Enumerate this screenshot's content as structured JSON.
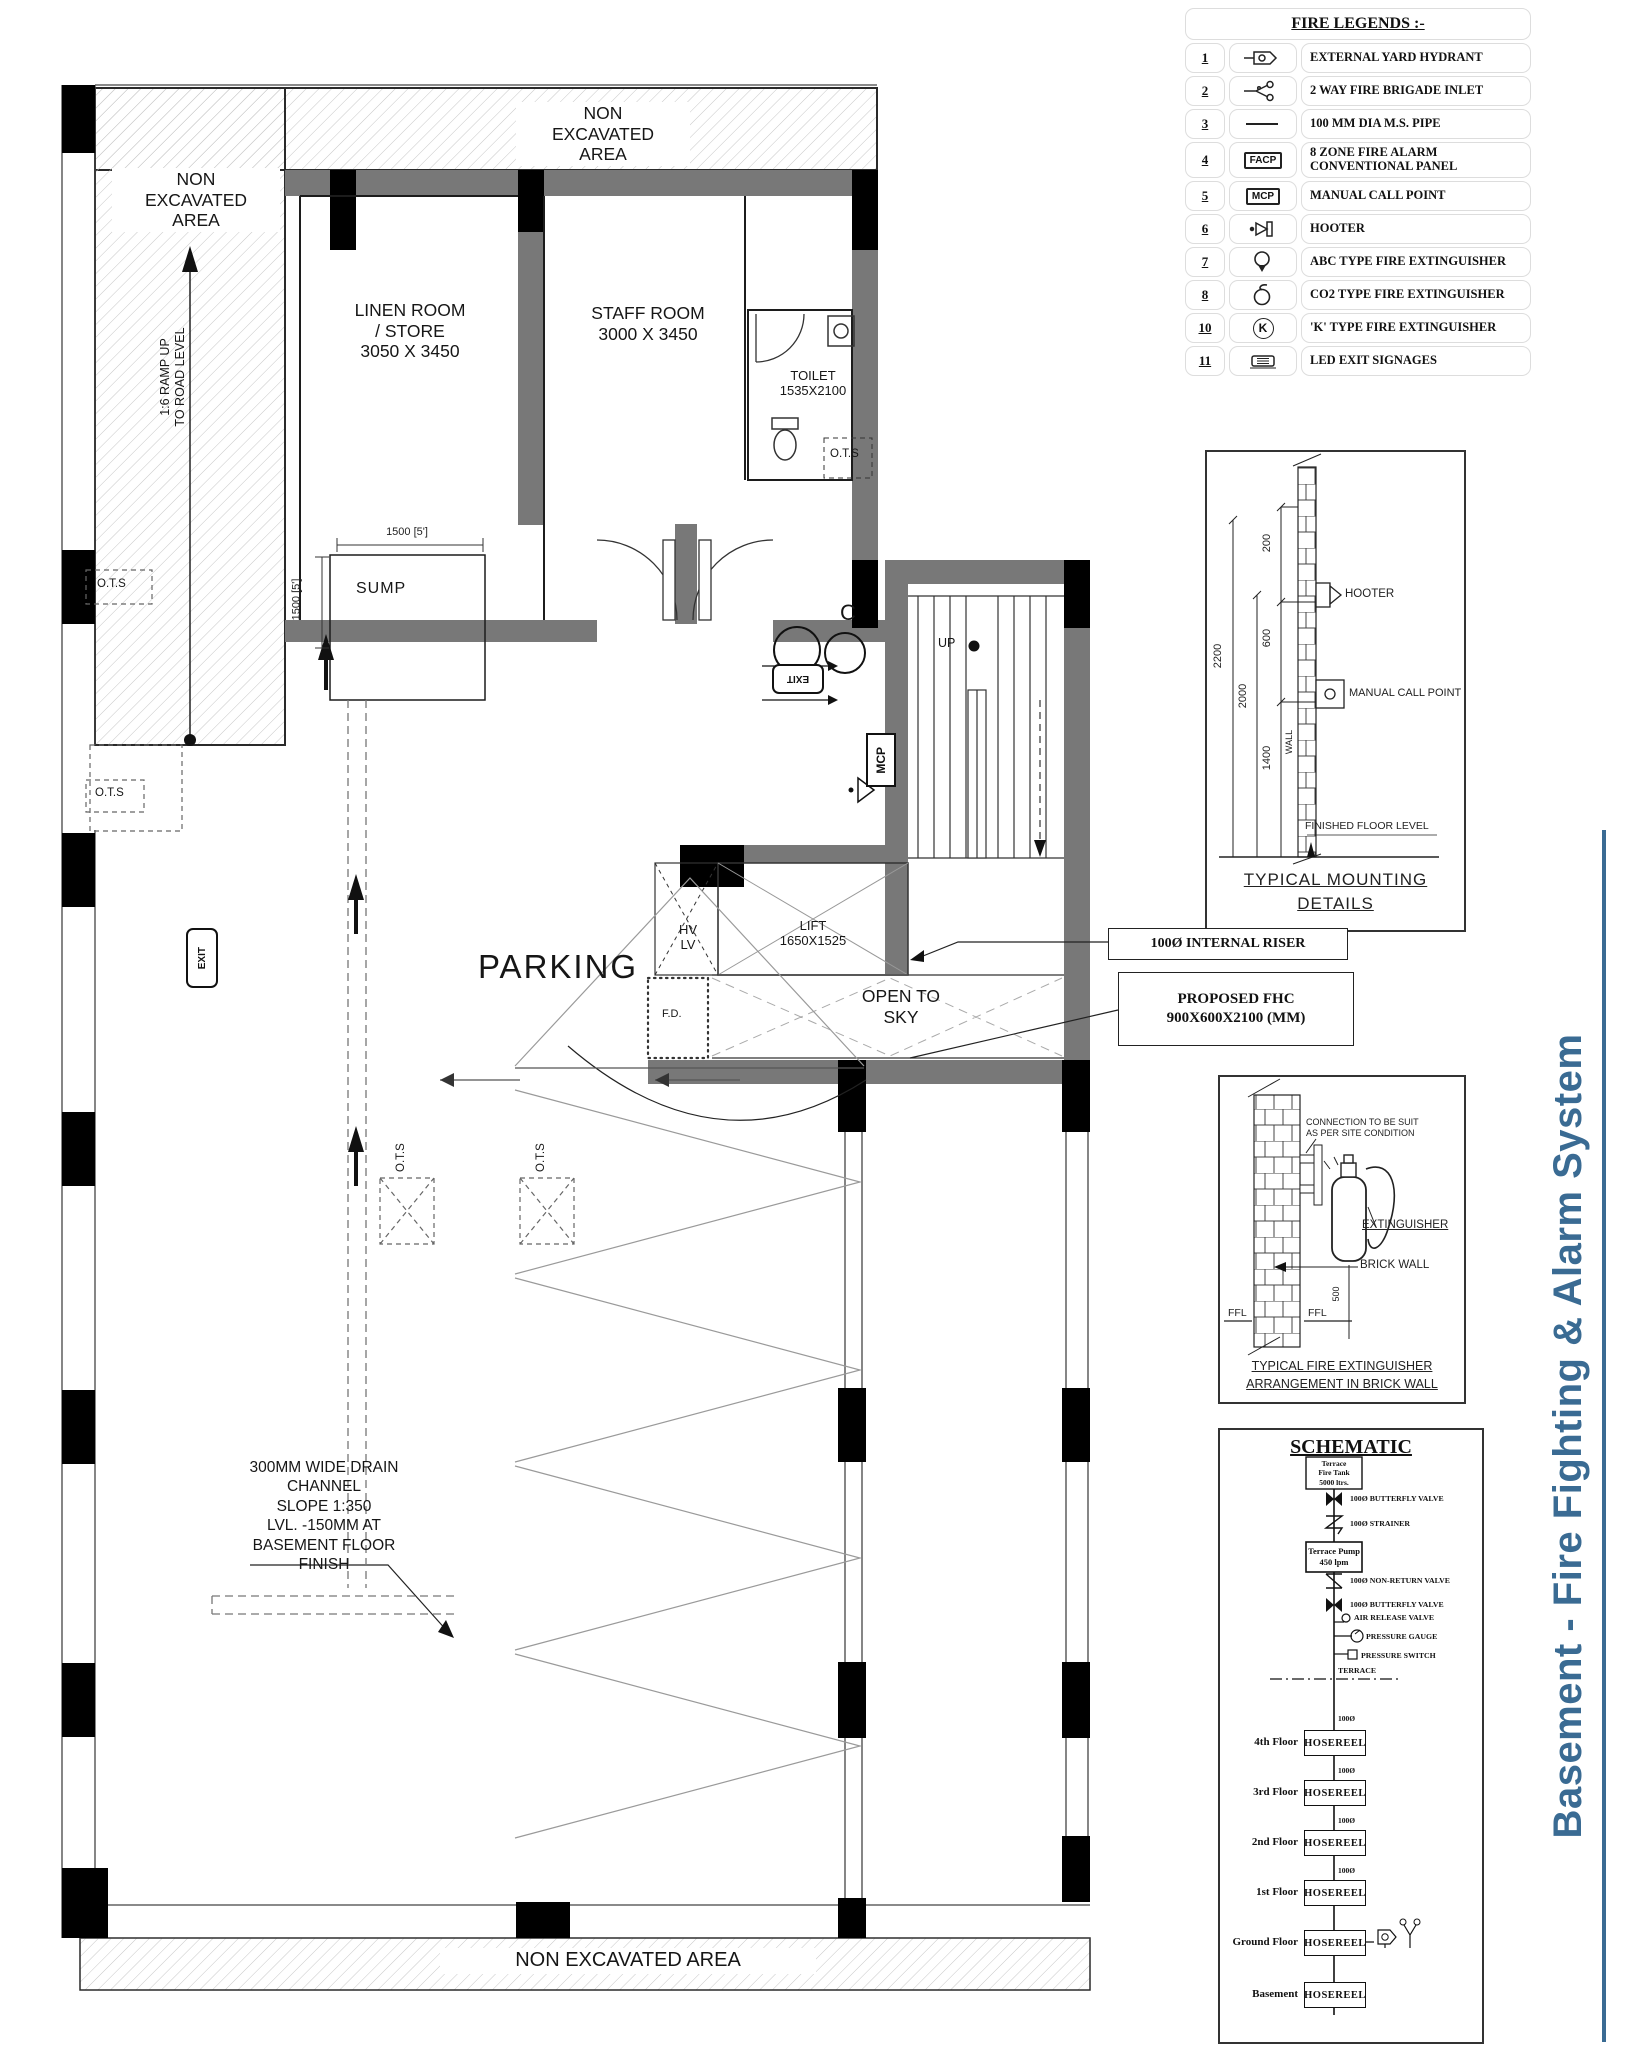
{
  "title": {
    "text": "Basement - Fire Fighting & Alarm System",
    "color": "#3a6b93"
  },
  "colors": {
    "wall_gray": "#787878",
    "column_black": "#000000",
    "hatch_gray": "#c7c7c7",
    "title_blue": "#3a6b93"
  },
  "legend": {
    "title": "FIRE LEGENDS :-",
    "rows": [
      {
        "num": "1",
        "icon": "yard-hydrant-icon",
        "label": "EXTERNAL YARD HYDRANT"
      },
      {
        "num": "2",
        "icon": "fire-brigade-inlet-icon",
        "label": "2 WAY FIRE BRIGADE INLET"
      },
      {
        "num": "3",
        "icon": "pipe-icon",
        "label": "100 MM DIA M.S. PIPE"
      },
      {
        "num": "4",
        "icon": "facp-icon",
        "icon_text": "FACP",
        "label": "8 ZONE FIRE ALARM\nCONVENTIONAL PANEL"
      },
      {
        "num": "5",
        "icon": "mcp-icon",
        "icon_text": "MCP",
        "label": "MANUAL CALL POINT"
      },
      {
        "num": "6",
        "icon": "hooter-icon",
        "label": "HOOTER"
      },
      {
        "num": "7",
        "icon": "abc-extinguisher-icon",
        "label": "ABC TYPE FIRE EXTINGUISHER"
      },
      {
        "num": "8",
        "icon": "co2-extinguisher-icon",
        "label": "CO2 TYPE FIRE EXTINGUISHER"
      },
      {
        "num": "10",
        "icon": "k-extinguisher-icon",
        "icon_text": "K",
        "label": "'K' TYPE FIRE EXTINGUISHER"
      },
      {
        "num": "11",
        "icon": "led-exit-icon",
        "label": "LED EXIT SIGNAGES"
      }
    ]
  },
  "mounting_details": {
    "title_line1": "TYPICAL  MOUNTING",
    "title_line2": "DETAILS",
    "hooter": "HOOTER",
    "mcp": "MANUAL  CALL  POINT",
    "ffl": "FINISHED  FLOOR  LEVEL",
    "wall": "WALL",
    "d2200": "2200",
    "d2000": "2000",
    "d1400": "1400",
    "d600": "600",
    "d200": "200"
  },
  "callouts": {
    "riser": "100Ø INTERNAL RISER",
    "fhc": "PROPOSED FHC\n900X600X2100 (MM)"
  },
  "extinguisher_detail": {
    "note": "CONNECTION TO BE SUIT\nAS PER SITE CONDITION",
    "extinguisher": "EXTINGUISHER",
    "brick_wall": "BRICK  WALL",
    "ffl_left": "FFL",
    "ffl_right": "FFL",
    "dim500": "500",
    "title_line1": "TYPICAL  FIRE  EXTINGUISHER",
    "title_line2": "ARRANGEMENT  IN  BRICK  WALL"
  },
  "schematic": {
    "title": "SCHEMATIC",
    "tank": "Terrace\nFire Tank\n5000 ltrs.",
    "pump": "Terrace Pump\n450 lpm",
    "labels": [
      "100Ø BUTTERFLY VALVE",
      "100Ø STRAINER",
      "100Ø NON-RETURN VALVE",
      "100Ø BUTTERFLY VALVE",
      "AIR RELEASE VALVE",
      "PRESSURE GAUGE",
      "PRESSURE SWITCH",
      "TERRACE"
    ],
    "pipe_label": "100Ø",
    "floors": [
      {
        "floor": "4th Floor",
        "unit": "HOSEREEL"
      },
      {
        "floor": "3rd Floor",
        "unit": "HOSEREEL"
      },
      {
        "floor": "2nd Floor",
        "unit": "HOSEREEL"
      },
      {
        "floor": "1st Floor",
        "unit": "HOSEREEL"
      },
      {
        "floor": "Ground Floor",
        "unit": "HOSEREEL"
      },
      {
        "floor": "Basement",
        "unit": "HOSEREEL"
      }
    ]
  },
  "plan": {
    "non_excavated_top_left": "NON\nEXCAVATED\nAREA",
    "non_excavated_top": "NON\nEXCAVATED\nAREA",
    "non_excavated_bottom": "NON EXCAVATED AREA",
    "ramp": "1:6 RAMP UP\nTO ROAD LEVEL",
    "linen_room": "LINEN ROOM\n/ STORE\n3050 X 3450",
    "staff_room": "STAFF ROOM\n3000 X 3450",
    "toilet": "TOILET\n1535X2100",
    "sump": "SUMP",
    "dim_1500_h": "1500 [5']",
    "dim_1500_v": "1500 [5']",
    "up": "UP",
    "mcp": "MCP",
    "lift": "LIFT\n1650X1525",
    "hv_lv": "HV\nLV",
    "fd": "F.D.",
    "open_to_sky": "OPEN TO\nSKY",
    "parking": "PARKING",
    "drain_note": "300MM WIDE DRAIN\nCHANNEL\nSLOPE 1:350\nLVL. -150MM AT\nBASEMENT FLOOR\nFINISH",
    "ots": "O.T.S",
    "exit": "EXIT",
    "c_mark": "C"
  }
}
